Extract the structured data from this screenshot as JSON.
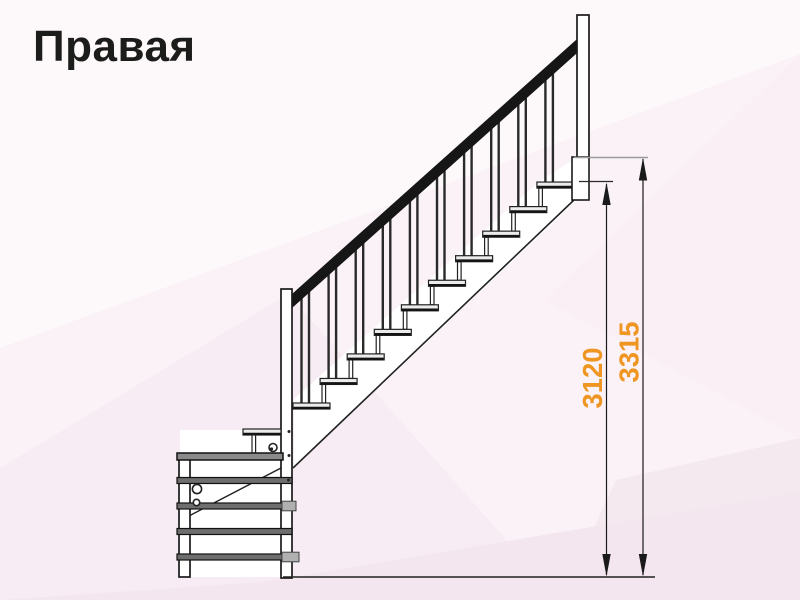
{
  "title": "Правая",
  "diagram": {
    "type": "staircase-side-view",
    "orientation_label": "Правая",
    "dimensions": [
      {
        "id": "height-to-top-tread",
        "value": "3120"
      },
      {
        "id": "height-to-floor-level",
        "value": "3315"
      }
    ],
    "features": {
      "straight_treads": 10,
      "winder_bars": 5,
      "baluster_pairs": 10
    }
  },
  "colors": {
    "dimension_text": "#EE9621",
    "line": "#222222",
    "line_strong": "#141414",
    "handrail": "#161616",
    "tread_fill": "#ececec",
    "bar_fill": "#6e6e6e",
    "cap_fill": "#b0b0b0",
    "post_fill": "#ffffff",
    "platform_line": "#9c9c9c",
    "background": "#fbf2f8"
  }
}
